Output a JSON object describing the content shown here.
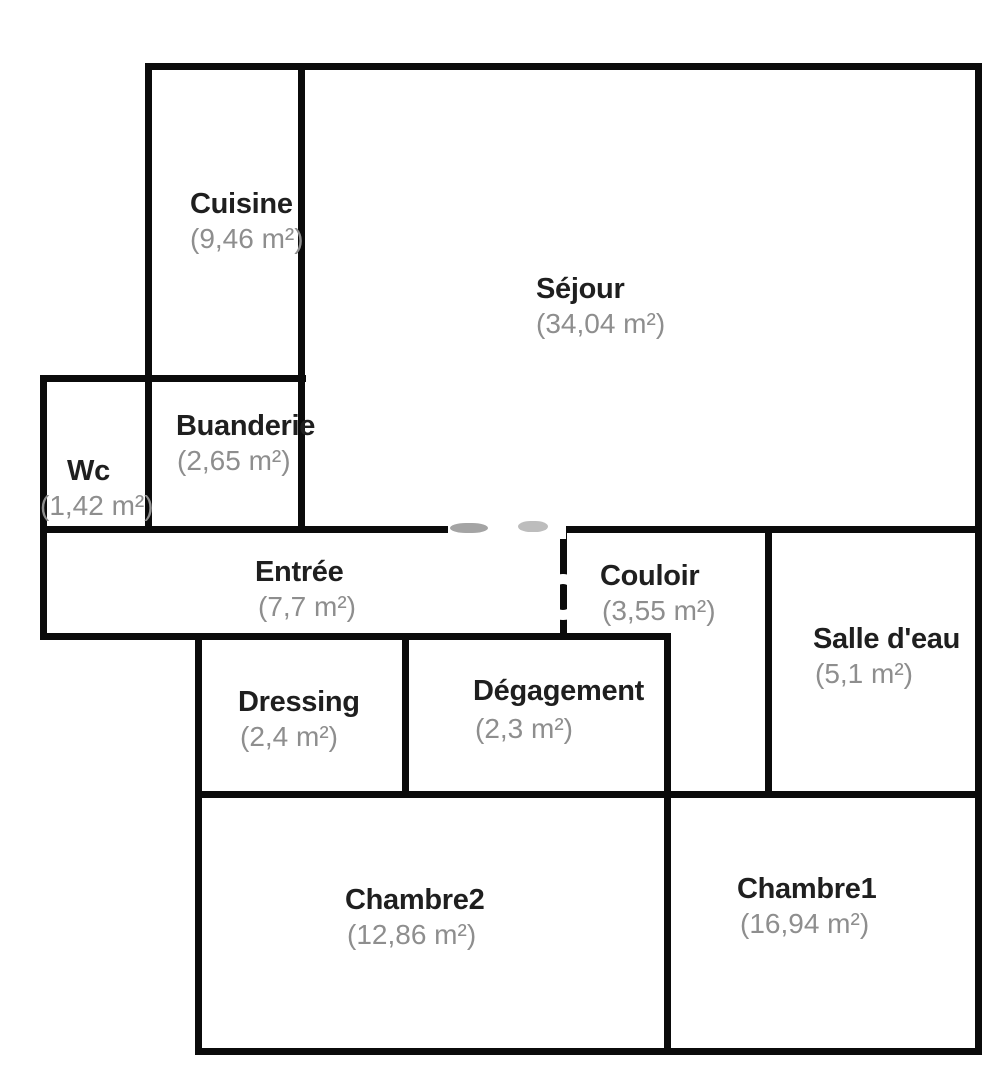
{
  "colors": {
    "background": "#ffffff",
    "wall": "#0b0b0b",
    "room_name_text": "#1f1f1f",
    "room_area_text": "#8e8e8e"
  },
  "rooms": [
    {
      "id": "cuisine",
      "name": "Cuisine",
      "area": "(9,46 m²)"
    },
    {
      "id": "sejour",
      "name": "Séjour",
      "area": "(34,04 m²)"
    },
    {
      "id": "buanderie",
      "name": "Buanderie",
      "area": "(2,65 m²)"
    },
    {
      "id": "wc",
      "name": "Wc",
      "area": "(1,42 m²)"
    },
    {
      "id": "entree",
      "name": "Entrée",
      "area": "(7,7 m²)"
    },
    {
      "id": "couloir",
      "name": "Couloir",
      "area": "(3,55 m²)"
    },
    {
      "id": "salle-deau",
      "name": "Salle d'eau",
      "area": "(5,1 m²)"
    },
    {
      "id": "dressing",
      "name": "Dressing",
      "area": "(2,4 m²)"
    },
    {
      "id": "degagement",
      "name": "Dégagement",
      "area": "(2,3 m²)"
    },
    {
      "id": "chambre2",
      "name": "Chambre2",
      "area": "(12,86 m²)"
    },
    {
      "id": "chambre1",
      "name": "Chambre1",
      "area": "(16,94 m²)"
    }
  ]
}
